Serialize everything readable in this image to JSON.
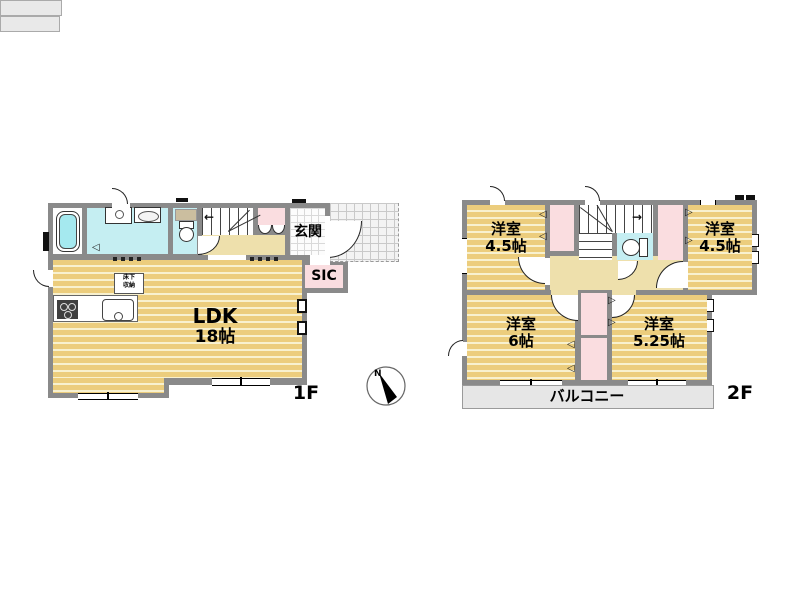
{
  "plan": {
    "f1": {
      "floor_label": "1F",
      "ldk": {
        "label": "LDK",
        "size": "18帖"
      },
      "genkan": {
        "label": "玄関"
      },
      "sic": {
        "label": "SIC"
      },
      "underfloor": {
        "line1": "床下",
        "line2": "収納"
      }
    },
    "f2": {
      "floor_label": "2F",
      "room_nw": {
        "label": "洋室",
        "size": "4.5帖"
      },
      "room_ne": {
        "label": "洋室",
        "size": "4.5帖"
      },
      "room_sw": {
        "label": "洋室",
        "size": "6帖"
      },
      "room_se": {
        "label": "洋室",
        "size": "5.25帖"
      },
      "balcony": {
        "label": "バルコニー"
      }
    },
    "compass": {
      "label": "N"
    }
  },
  "colors": {
    "wall": "#8a8a8a",
    "wood_dark": "#eccd7d",
    "wood_light": "#f8f1cf",
    "water_room": "#c5eef2",
    "closet": "#fadde0",
    "hallway": "#eee0ac",
    "balcony": "#e6e6e6"
  }
}
